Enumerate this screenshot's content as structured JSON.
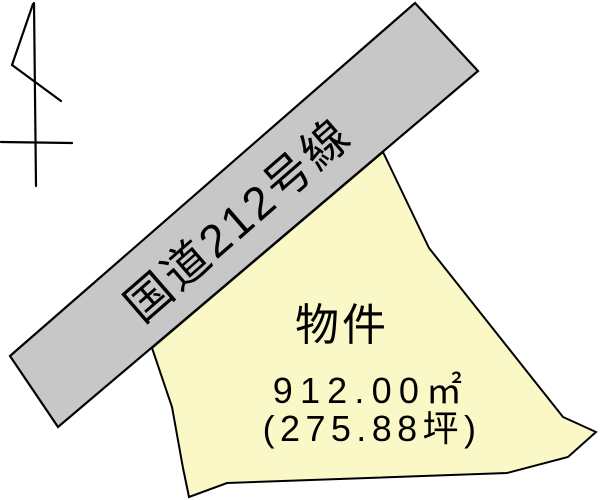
{
  "page": {
    "background": "#ffffff"
  },
  "north_arrow": {
    "icon": "north-arrow-icon"
  },
  "road": {
    "label": "国道212号線",
    "fill": "#c7c7c7",
    "outline": "#000000"
  },
  "property": {
    "label": "物件",
    "area_sqm": "912.00㎡",
    "area_tsubo": "(275.88坪)",
    "fill": "#faf8c6",
    "outline": "#000000"
  }
}
